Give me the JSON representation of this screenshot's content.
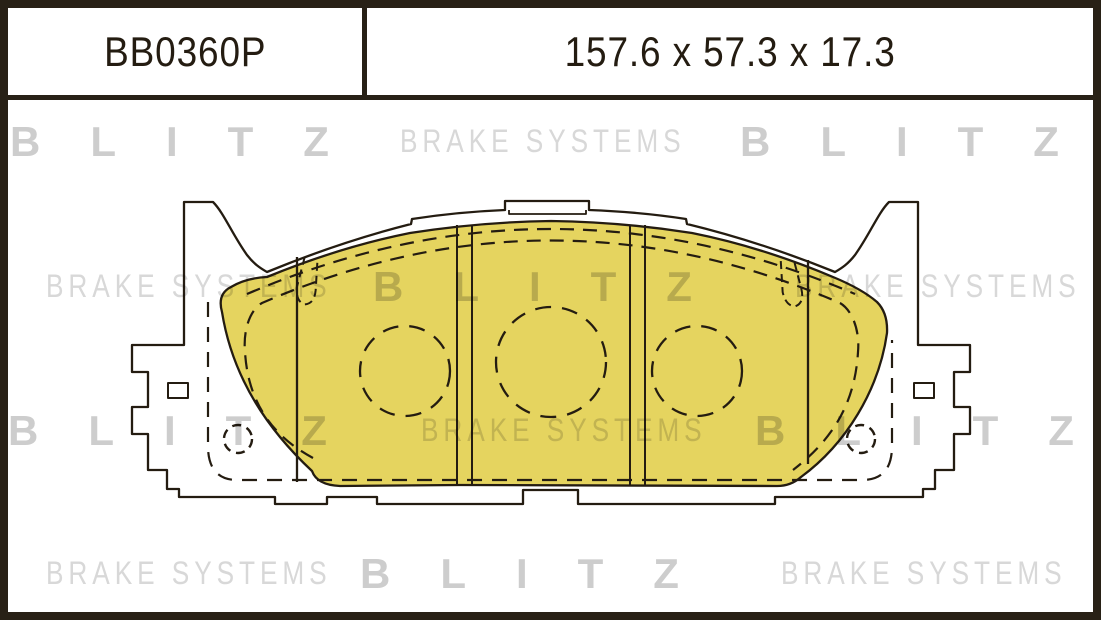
{
  "header": {
    "part_number": "BB0360P",
    "dimensions": "157.6 x 57.3 x 17.3"
  },
  "watermark": {
    "rows": [
      {
        "items": [
          {
            "text": "BLITZ",
            "style": "bold",
            "x": 10,
            "y": 118
          },
          {
            "text": "BRAKE SYSTEMS",
            "style": "thin",
            "x": 400,
            "y": 123
          },
          {
            "text": "BLITZ",
            "style": "bold",
            "x": 740,
            "y": 118
          }
        ]
      },
      {
        "items": [
          {
            "text": "BRAKE SYSTEMS",
            "style": "thin",
            "x": 46,
            "y": 268
          },
          {
            "text": "BLITZ",
            "style": "bold",
            "x": 373,
            "y": 263
          },
          {
            "text": "BRAKE SYSTEMS",
            "style": "thin",
            "x": 795,
            "y": 268
          }
        ]
      },
      {
        "items": [
          {
            "text": "BLITZ",
            "style": "bold",
            "x": 8,
            "y": 407
          },
          {
            "text": "BRAKE SYSTEMS",
            "style": "thin",
            "x": 421,
            "y": 412
          },
          {
            "text": "BLITZ",
            "style": "bold",
            "x": 755,
            "y": 407
          }
        ]
      },
      {
        "items": [
          {
            "text": "BRAKE SYSTEMS",
            "style": "thin",
            "x": 46,
            "y": 555
          },
          {
            "text": "BLITZ",
            "style": "bold",
            "x": 360,
            "y": 550
          },
          {
            "text": "BRAKE SYSTEMS",
            "style": "thin",
            "x": 781,
            "y": 555
          }
        ]
      }
    ]
  },
  "colors": {
    "pad_yellow": "#e5d45f",
    "line": "#241c11",
    "frame": "#282116",
    "watermark_bold": "#cdcdcd",
    "watermark_thin": "#d8d8d8"
  },
  "drawing": {
    "description": "Front view technical drawing of a disc brake pad: yellow friction material on backing plate with side ears, two vertical wear slots, three dashed wear-indicator circles and two rivet holes"
  }
}
